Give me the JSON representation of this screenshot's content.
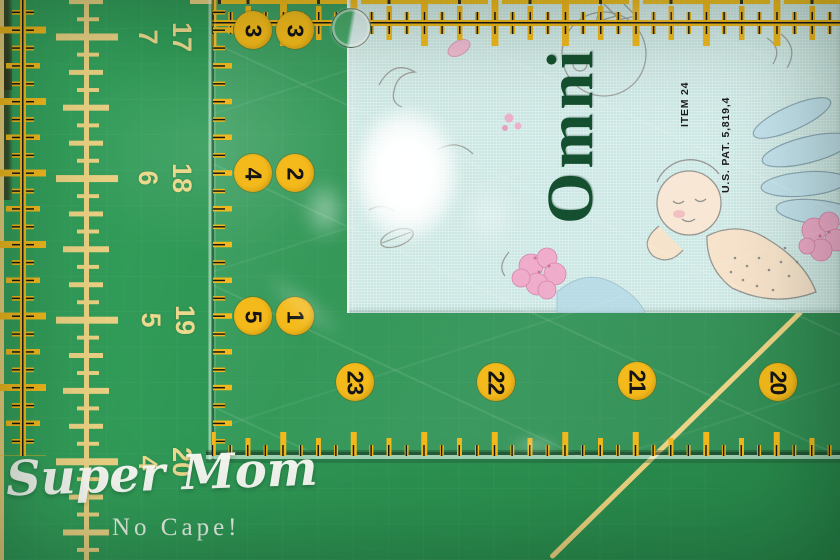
{
  "scene": {
    "description": "Omnigrid quilting ruler lying on a green self-healing cutting mat, measuring a strip of aqua cherub-print fabric"
  },
  "mat": {
    "surface_color": "#2e9454",
    "grid_color": "#e9cf7d",
    "scale_numbers": [
      {
        "primary": "17",
        "secondary": "7"
      },
      {
        "primary": "18",
        "secondary": "6"
      },
      {
        "primary": "19",
        "secondary": "5"
      },
      {
        "primary": "20",
        "secondary": "4"
      }
    ]
  },
  "ruler": {
    "brand": "Omni",
    "item_label": "ITEM 24",
    "patent_label": "U.S. PAT. 5,819,4",
    "marking_color": "#f2b81c",
    "logo_color": "#14502f",
    "inch_pairs": [
      {
        "left": "3",
        "right": "3"
      },
      {
        "left": "4",
        "right": "2"
      },
      {
        "left": "5",
        "right": "1"
      }
    ],
    "edge_numbers": [
      "23",
      "22",
      "21",
      "20"
    ]
  },
  "watermark": {
    "line1": "Super Mom",
    "line2": "No Cape!"
  }
}
